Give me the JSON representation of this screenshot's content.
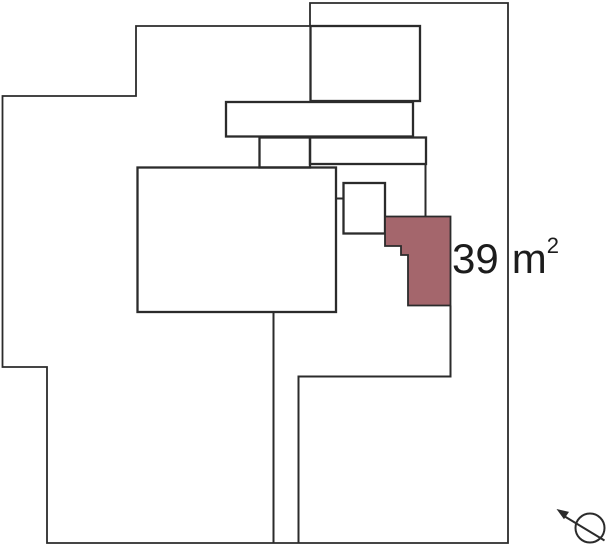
{
  "area": {
    "value": "39",
    "unit": "m",
    "sup": "2"
  },
  "colors": {
    "highlight_fill": "#a4666c",
    "outline": "#2b2b2b",
    "background": "#ffffff",
    "label_text": "#1c1c1c"
  },
  "icons": {
    "compass": "north-arrow-icon"
  }
}
